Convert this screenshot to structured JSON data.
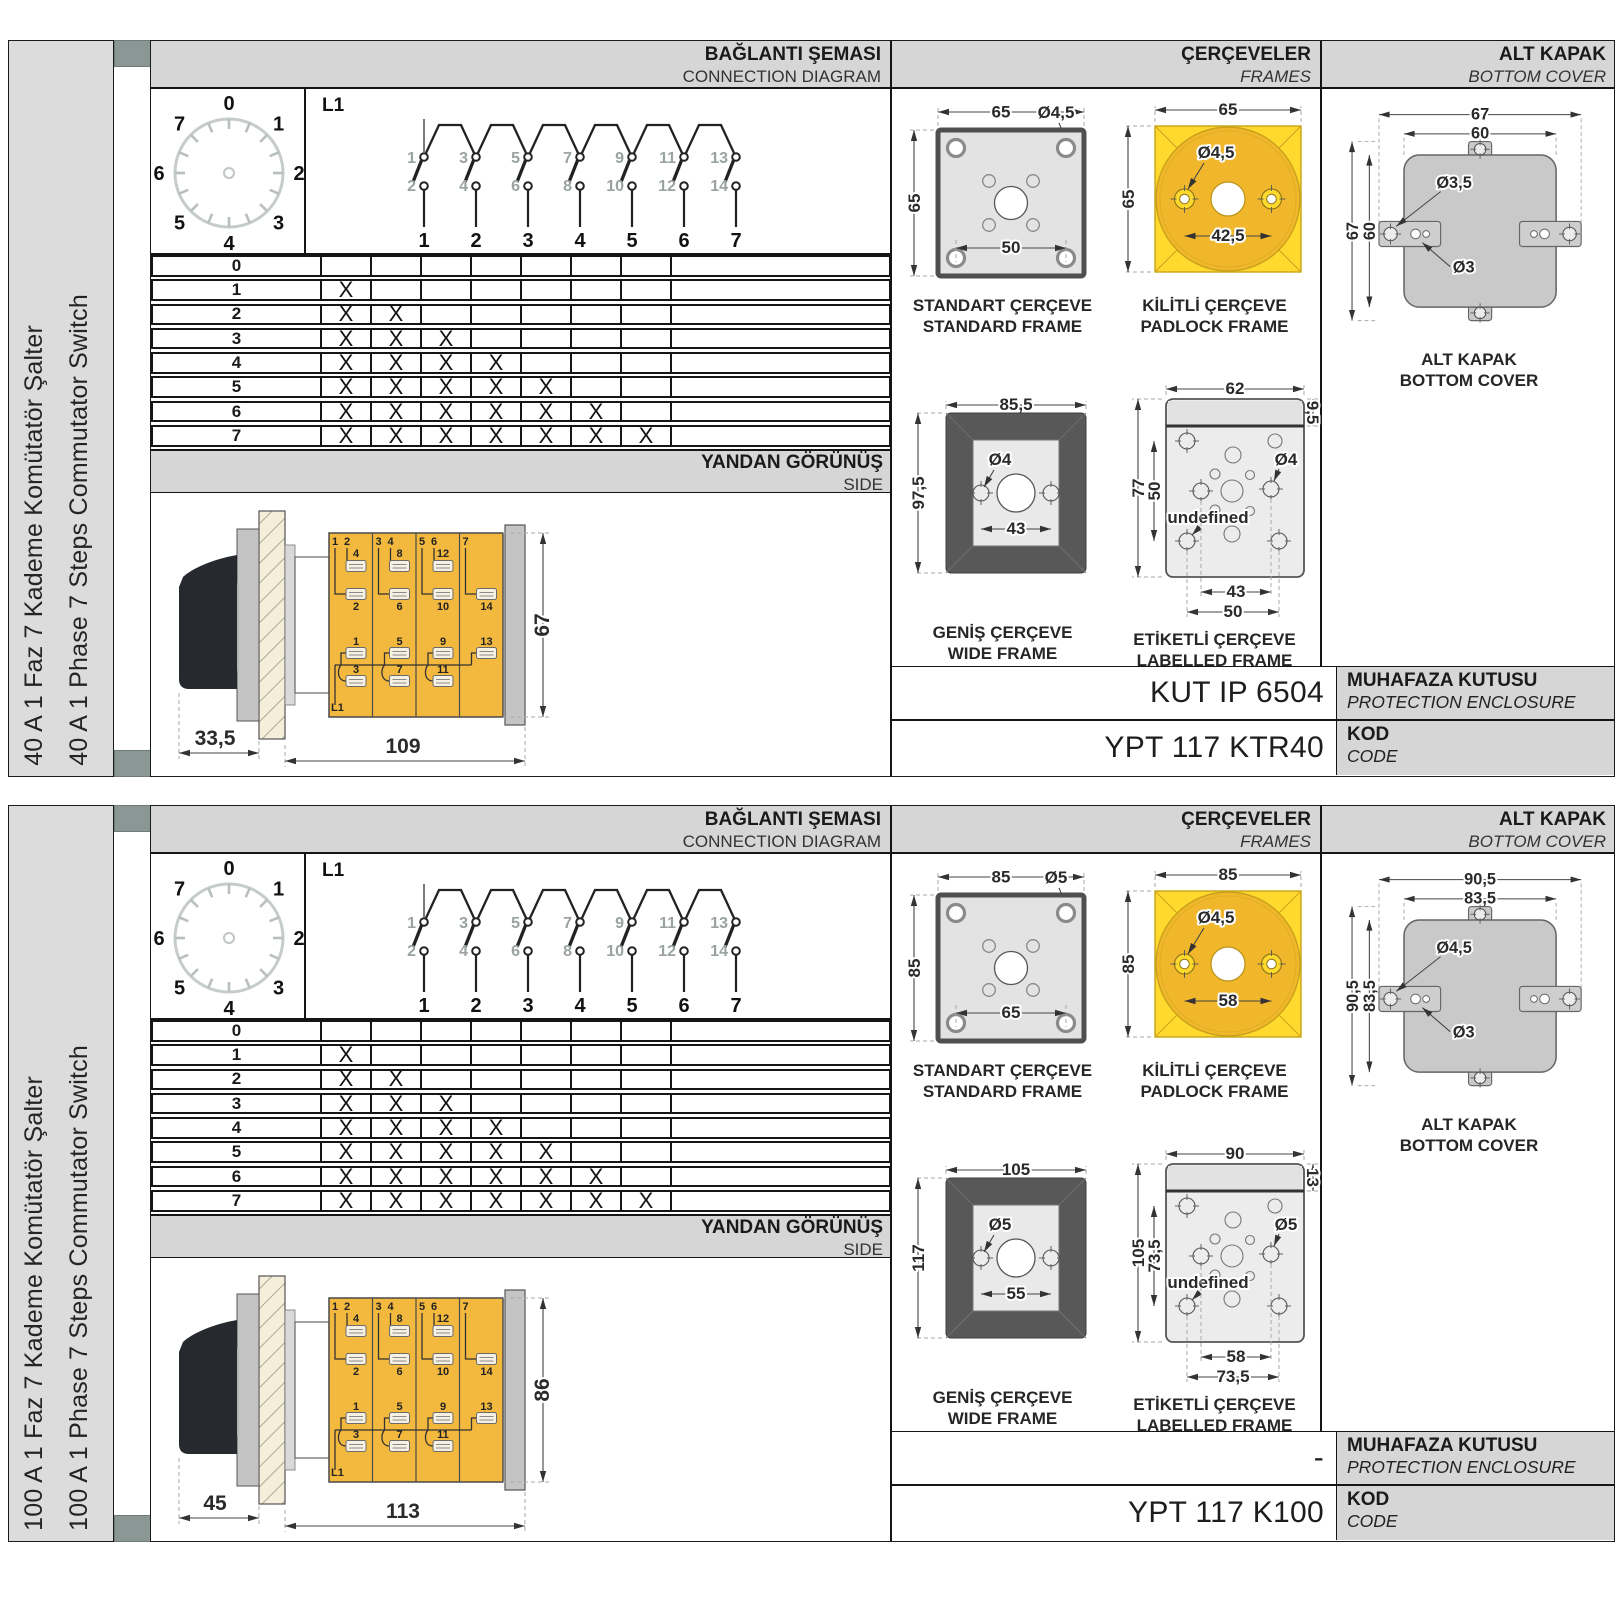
{
  "colors": {
    "band": "#d6d6d6",
    "panel": "#dcdcdc",
    "accent_square": "#8b9794",
    "body_yellow": "#f3b93e",
    "padlock_yellow": "#ffd92e",
    "padlock_circle": "#f1b72c",
    "frame_fill": "#e3e3e3",
    "wide_frame_ring": "#585858",
    "cover_gray": "#c9c9c9",
    "ink": "#1a1a1a"
  },
  "common": {
    "header": {
      "connection_tr": "BAĞLANTI ŞEMASI",
      "connection_en": "CONNECTION DIAGRAM",
      "frames_tr": "ÇERÇEVELER",
      "frames_en": "FRAMES",
      "cover_tr": "ALT KAPAK",
      "cover_en": "BOTTOM COVER"
    },
    "side_band": {
      "tr": "YANDAN GÖRÜNÜŞ",
      "en": "SIDE"
    },
    "dial": {
      "positions": [
        "0",
        "1",
        "2",
        "3",
        "4",
        "5",
        "6",
        "7"
      ]
    },
    "circuit": {
      "feed": "L1",
      "top_contacts": [
        "1",
        "3",
        "5",
        "7",
        "9",
        "11",
        "13"
      ],
      "bottom_contacts": [
        "2",
        "4",
        "6",
        "8",
        "10",
        "12",
        "14"
      ],
      "outputs": [
        "1",
        "2",
        "3",
        "4",
        "5",
        "6",
        "7"
      ]
    },
    "steps_table": {
      "x_mark": "X",
      "columns": 7,
      "steps": [
        {
          "label": "0",
          "marks": 0
        },
        {
          "label": "1",
          "marks": 1
        },
        {
          "label": "2",
          "marks": 2
        },
        {
          "label": "3",
          "marks": 3
        },
        {
          "label": "4",
          "marks": 4
        },
        {
          "label": "5",
          "marks": 5
        },
        {
          "label": "6",
          "marks": 6
        },
        {
          "label": "7",
          "marks": 7
        }
      ]
    },
    "side_view_body": {
      "feed": "L1",
      "group_labels": [
        [
          "1",
          "2"
        ],
        [
          "3",
          "4"
        ],
        [
          "5",
          "6"
        ],
        [
          "7"
        ]
      ],
      "upper_terminals": [
        [
          "4",
          "2"
        ],
        [
          "8",
          "6"
        ],
        [
          "12",
          "10"
        ],
        [
          "",
          "14"
        ]
      ],
      "lower_terminals": [
        [
          "1",
          "3"
        ],
        [
          "5",
          "7"
        ],
        [
          "9",
          "11"
        ],
        [
          "13",
          ""
        ]
      ]
    },
    "frame_captions": {
      "standard_tr": "STANDART ÇERÇEVE",
      "standard_en": "STANDARD FRAME",
      "padlock_tr": "KİLİTLİ ÇERÇEVE",
      "padlock_en": "PADLOCK FRAME",
      "wide_tr": "GENİŞ ÇERÇEVE",
      "wide_en": "WIDE FRAME",
      "labelled_tr": "ETİKETLİ ÇERÇEVE",
      "labelled_en": "LABELLED FRAME"
    },
    "cover_caption": {
      "tr": "ALT KAPAK",
      "en": "BOTTOM COVER"
    },
    "enclosure_label": {
      "tr": "MUHAFAZA KUTUSU",
      "en": "PROTECTION ENCLOSURE"
    },
    "code_label": {
      "tr": "KOD",
      "en": "CODE"
    }
  },
  "sections": [
    {
      "name_tr": "40 A 1 Faz 7 Kademe Komütatör Şalter",
      "name_en": "40 A 1 Phase 7 Steps Commutator Switch",
      "side_view": {
        "handle_depth": "33,5",
        "body_length": "109",
        "height": "67"
      },
      "standard_frame": {
        "width": "65",
        "height": "65",
        "hole": "Ø4,5",
        "hole_spacing": "50"
      },
      "padlock_frame": {
        "width": "65",
        "height": "65",
        "hole": "Ø4,5",
        "hole_spacing": "42,5"
      },
      "wide_frame": {
        "width": "85,5",
        "height": "97,5",
        "hole": "Ø4",
        "hole_spacing": "43"
      },
      "labelled_frame": {
        "width": "62",
        "label_strip": "9,5",
        "height": "77",
        "hole_span": "50",
        "hole_right": "Ø4",
        "hole_left": "Ø3,5",
        "spacing_inner": "43",
        "spacing_outer": "50"
      },
      "bottom_cover": {
        "width_outer": "67",
        "width_inner": "60",
        "height_outer": "67",
        "height_inner": "60",
        "hole_big": "Ø3,5",
        "hole_small": "Ø3"
      },
      "enclosure_value": "KUT IP 6504",
      "code_value": "YPT 117 KTR40"
    },
    {
      "name_tr": "100 A 1 Faz 7 Kademe Komütatör Şalter",
      "name_en": "100 A 1 Phase 7 Steps Commutator Switch",
      "side_view": {
        "handle_depth": "45",
        "body_length": "113",
        "height": "86"
      },
      "standard_frame": {
        "width": "85",
        "height": "85",
        "hole": "Ø5",
        "hole_spacing": "65"
      },
      "padlock_frame": {
        "width": "85",
        "height": "85",
        "hole": "Ø4,5",
        "hole_spacing": "58"
      },
      "wide_frame": {
        "width": "105",
        "height": "117",
        "hole": "Ø5",
        "hole_spacing": "55"
      },
      "labelled_frame": {
        "width": "90",
        "label_strip": "13",
        "height": "105",
        "hole_span": "73,5",
        "hole_right": "Ø5",
        "hole_left": "Ø5",
        "spacing_inner": "58",
        "spacing_outer": "73,5"
      },
      "bottom_cover": {
        "width_outer": "90,5",
        "width_inner": "83,5",
        "height_outer": "90,5",
        "height_inner": "83,5",
        "hole_big": "Ø4,5",
        "hole_small": "Ø3"
      },
      "enclosure_value": "-",
      "code_value": "YPT 117 K100"
    }
  ]
}
